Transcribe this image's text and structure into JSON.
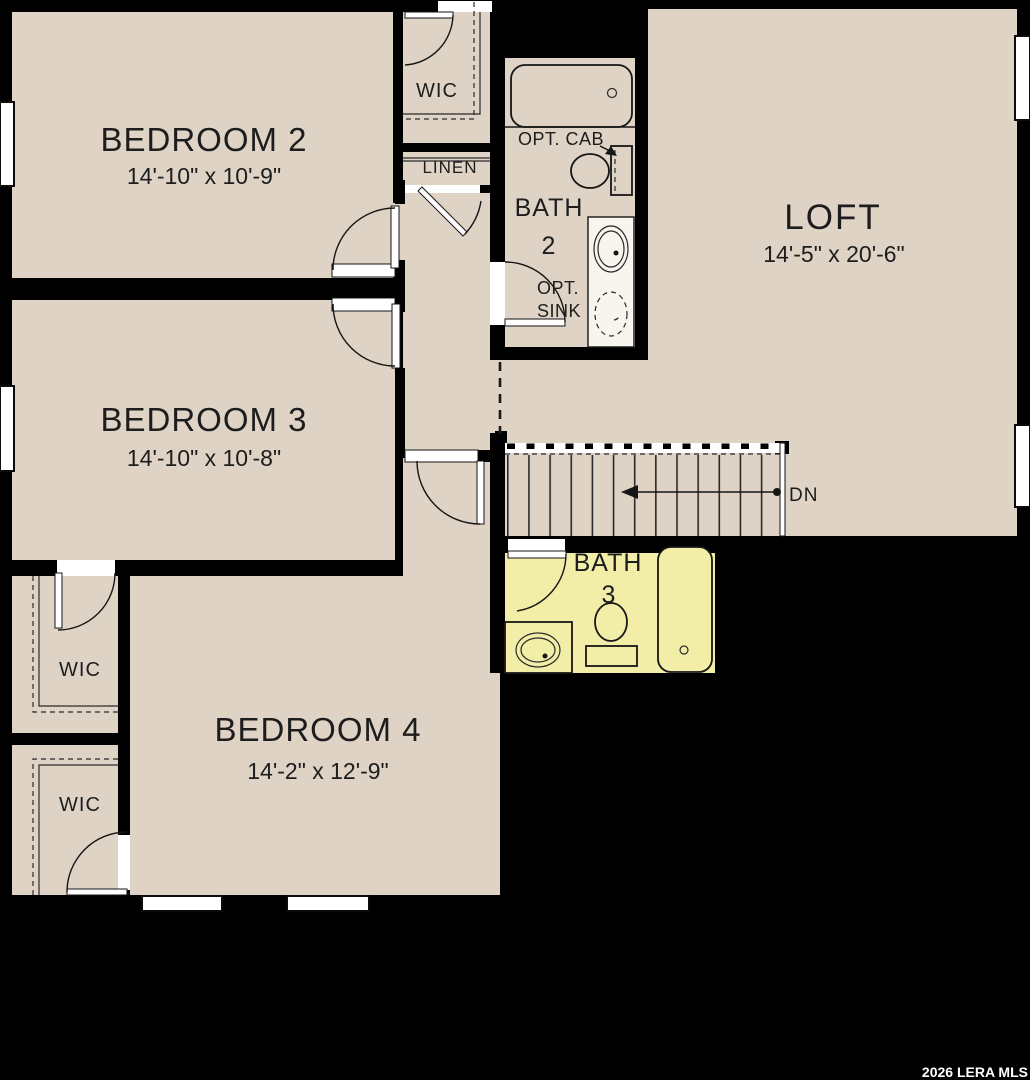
{
  "floorplan": {
    "watermark": "2026 LERA MLS",
    "rooms": {
      "bedroom2": {
        "name": "BEDROOM 2",
        "dims": "14'-10\" x 10'-9\""
      },
      "bedroom3": {
        "name": "BEDROOM 3",
        "dims": "14'-10\" x 10'-8\""
      },
      "bedroom4": {
        "name": "BEDROOM 4",
        "dims": "14'-2\" x 12'-9\""
      },
      "loft": {
        "name": "LOFT",
        "dims": "14'-5\" x 20'-6\""
      },
      "bath2": {
        "name": "BATH",
        "number": "2"
      },
      "bath3": {
        "name": "BATH",
        "number": "3"
      },
      "wic_top": {
        "name": "WIC"
      },
      "wic_mid": {
        "name": "WIC"
      },
      "wic_bottom": {
        "name": "WIC"
      },
      "linen": {
        "name": "LINEN"
      }
    },
    "annotations": {
      "opt_cab": "OPT. CAB",
      "opt_sink_line1": "OPT.",
      "opt_sink_line2": "SINK",
      "down": "DN"
    },
    "colors": {
      "background": "#000000",
      "floor": "#ded3c5",
      "bath3_highlight": "#f2eda7",
      "fixture_counter": "#f8f5ee",
      "text": "#1d1d1d",
      "watermark_text": "#ffffff"
    }
  }
}
